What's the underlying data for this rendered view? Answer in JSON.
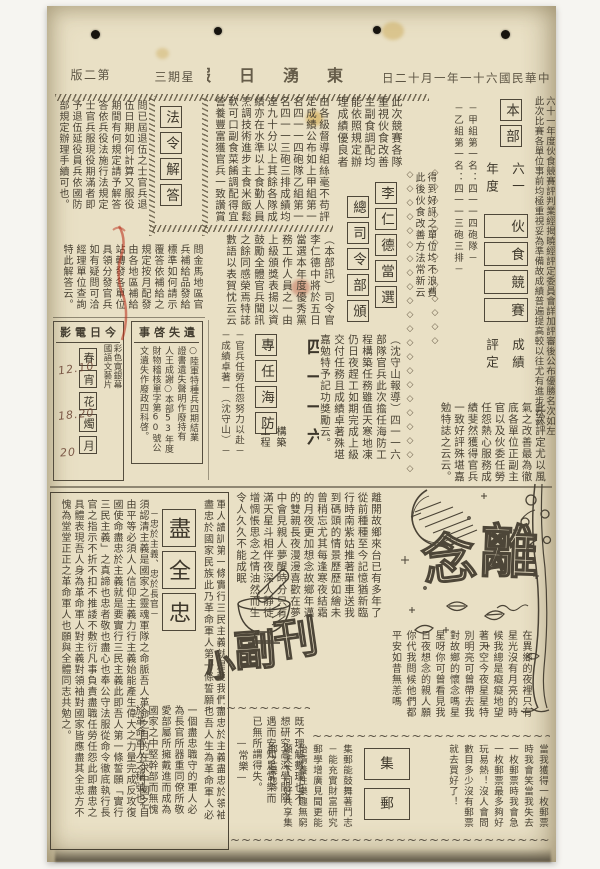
{
  "meta": {
    "date": "中華民國六十一年一月十二日",
    "paper_name": "東湧日報",
    "weekday": "星期三",
    "edition": "第二版"
  },
  "deco": {
    "diamonds13": "◇◇◇◇◇◇◇◇◇◇◇◇◇",
    "diamonds22": "◇◇◇◇◇◇◇◇◇◇◇◇◇◇◇◇◇◇◇◇◇◇",
    "wave": "~~~~~~~~~~~~~~~~~~~~~~~~~~~~~~~~~~~~~~~~~~~~~~~~~~~~~~~~"
  },
  "a_mess": {
    "lead": "六十一年度伙食競賽評判業經揭曉經評定委員會詳加評審後公布優勝名次如左\n此次比賽各單位事前均極重視妥為準備故成績普遍提高較以往尤有進步云云",
    "title_top": "本部",
    "title_mid": "六一\n年度",
    "title_main": "伙食競賽",
    "title_bot": "成績\n評定",
    "kicker": "－甲組第一名：四一一四砲隊－\n－乙組第一名：四一一三砲三排－",
    "body_right": "此次競賽各隊\n重視伙食改善\n主副食調配均\n能依照規定辦\n理成績優良者",
    "mid_note": "得到好評之單位均不浪費\n此後伙食改善方法常新云",
    "body_left": "由各級督導組絲毫不苟評\n定成績公布如上甲組第一\n名四一一四砲隊乙組第一\n名四一一三砲三排成績均\n達九十分以上其餘各隊成\n績亦在水準以上食勤人員\n烹調技術進步主食米飯鬆\n軟可口副食菜餚調配得宜\n營養豐富獲官兵一致讚賞",
    "body_bottom": "此次評定尤以風\n氣之改善最為徹\n底各單位正副主\n官以及伙委任勞\n任怨熱心服務成\n績斐然獲得官兵\n一致好評殊堪嘉\n勉特誌之云云。"
  },
  "a_li": {
    "title": "李仁德當選",
    "title2": "總司令部頒",
    "body": "（本部訊）司令官\n李仁德中將於五日\n當選本年度優秀黨\n務工作人員之一由\n上級頒獎表揚以資\n鼓勵全體官兵聞訊\n之餘同感榮焉特誌\n數語以表賀忱云云"
  },
  "a_def": {
    "unit": "四一一六",
    "boxed": "專任海防",
    "sub": "構築\n工程",
    "kicker": "－官兵任勞任怨努力以赴－\n－成績卓著－（沈守山）－",
    "body": "（沈守山報導）四一一六\n部隊官兵此次擔任海防工\n程構築任務雖值天寒地凍\n仍日夜趕工如期完成上級\n交付任務且成績卓著殊堪\n嘉勉特予記功獎勵云。"
  },
  "law": {
    "title": "法令解答",
    "q1": "問已屆退伍之士官兵退\n伍日期如何計算又服役\n期間有何規定請予解答\n答依兵役法施行法規定\n士官兵服現役期滿者即\n予退伍延役員兵依國防\n部規定辦理手續可也。",
    "q2": "問金馬地區官\n兵補給品發給\n標準如何請示\n覆答依補給之\n規定按月配發\n由各地區補給\n站轉發各單位\n具領分發官兵\n如有疑問可洽\n經理單位查詢\n特此解答云。"
  },
  "movies": {
    "header": "今日電影",
    "film": "春宵花燭月",
    "note": "彩色寬銀幕\n國語文藝片",
    "times1": "12.10",
    "times2": "18.20",
    "times3": "20"
  },
  "lost": {
    "header": "遺失啓事",
    "body": "○陸軍特種兵四期結業\n證書遺失聲明作廢持有\n人王成謝○本部53年度\n財物稽核單字第60號公\n文遺失作廢政四科啓。"
  },
  "loyal": {
    "title": "盡全忠",
    "side": "－忠於主義、忠於長官－",
    "intro": "軍人讀訓第一條實行三民主義就是要我們盡忠於主義盡忠於領袖\n盡忠於國家民族此乃革命軍人第一條誓願也吾人生為革命軍人必",
    "left": "須認清主義是國家之靈魂軍隊之命脈吾人革命之目的在求中國之自\n由平等必須人人信仰主義力行主義始能產生偉大之力量完成反攻復\n國使命盡忠於主義就是要實行三民主義此即吾人第一條誓願「實行\n三民主義」之真諦也忠者敬也盡心也奉公守法服從命令徹底執行長\n官之指示不折不扣不推諉不敷衍凡事負責盡職任勞任怨此即盡忠之\n具體表現吾人身為革命軍人對主義對領袖對國家皆應盡其全忠方不\n愧為堂堂正正之革命軍人也願與全體同志共勉之。",
    "bottom": "一個盡忠職守的軍人必\n為長官所器重同僚所敬\n愛部屬所擁戴進而成為\n國家之中堅幹部而無愧\n於革命軍人之稱號也。"
  },
  "depart": {
    "title_1": "離",
    "title_2": "念",
    "left": "離開故鄉來台已有多年了\n從前種種至今記憶猶新臨\n行時南紫姑推著單車送我\n到碼頭的情景歷歷如繪未\n曾稍忘尤其每逢寒夜結霜\n的月夜更加想念故鄉年邁\n的雙親長夜漫漫喜歡在夢\n中會見親人夢醒時分只有\n滿天星斗相伴夜深人靜徒\n增惆悵思念之情油然而生\n令人久久不能成眠",
    "bottom": "在異鄉的夜裡只有\n星光沒有月亮的時\n候我總是癡癡地望\n著天空今夜星星特\n別明亮可曾帶去我\n對故鄉的懷念嗎星\n星呀你可曾看見我\n日夜想念的親人願\n你代我問候他們都\n平安如昔無恙嗎"
  },
  "supp": {
    "title_k1": "刊",
    "title_k2": "副",
    "title_k3": "小",
    "body": "既不理解數理也不\n想研究高深學問隨\n遇而安知足常樂而\n已無所謂得失。\n　　—常樂—"
  },
  "stamp": {
    "title": "集郵",
    "right": "當我獲得一枚郵票\n時我會笑當我失去\n一枚郵票時我會急\n一枚郵票最多夠好\n玩易熱！沒人會問\n數目多少沒有郵票\n就去買好了！",
    "left": "集郵能鼓舞著鬥志\n－能充實財富研究\n郵學增廣見聞更能\n怡情養性樂趣無窮\n願天下同好共享集\n郵之樂也。"
  }
}
